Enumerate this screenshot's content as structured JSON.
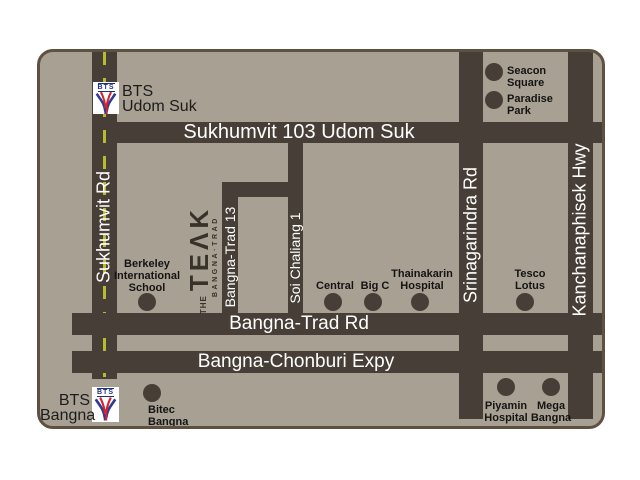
{
  "colors": {
    "page_bg": "#ffffff",
    "card_bg": "#a8a193",
    "card_border": "#5f5142",
    "road": "#473f37",
    "lane_dash": "#b6bb2f",
    "road_label": "#ffffff",
    "landmark_label": "#141414",
    "logo_text": "#39322b",
    "bts_navy": "#1e2f7d",
    "bts_red": "#d8232a",
    "bts_blue": "#2a3c94"
  },
  "roads": {
    "sukhumvit": "Sukhumvit Rd",
    "sukhumvit103": "Sukhumvit 103 Udom Suk",
    "srinagarindra": "Srinagarindra Rd",
    "kanchanaphisek": "Kanchanaphisek Hwy",
    "bangnatrad": "Bangna-Trad Rd",
    "expressway": "Bangna-Chonburi Expy",
    "bangnatrad13": "Bangna-Trad 13",
    "soichaliang": "Soi Chaliang 1"
  },
  "stations": {
    "udomsuk": {
      "logo_text": "BTS",
      "line1": "BTS",
      "line2": "Udom Suk"
    },
    "bangna": {
      "logo_text": "BTS",
      "line1": "BTS",
      "line2": "Bangna"
    }
  },
  "project_logo": {
    "the": "THE",
    "name": "TEΛK",
    "subtitle": "BANGNA·TRAD"
  },
  "landmarks": {
    "seacon": {
      "line1": "Seacon",
      "line2": "Square"
    },
    "paradise": {
      "line1": "Paradise",
      "line2": "Park"
    },
    "berkeley": {
      "line1": "Berkeley",
      "line2": "International",
      "line3": "School"
    },
    "central": {
      "line1": "Central"
    },
    "bigc": {
      "line1": "Big C"
    },
    "thainakarin": {
      "line1": "Thainakarin",
      "line2": "Hospital"
    },
    "tesco": {
      "line1": "Tesco",
      "line2": "Lotus"
    },
    "bitec": {
      "line1": "Bitec",
      "line2": "Bangna"
    },
    "piyamin": {
      "line1": "Piyamin",
      "line2": "Hospital"
    },
    "mega": {
      "line1": "Mega",
      "line2": "Bangna"
    }
  }
}
